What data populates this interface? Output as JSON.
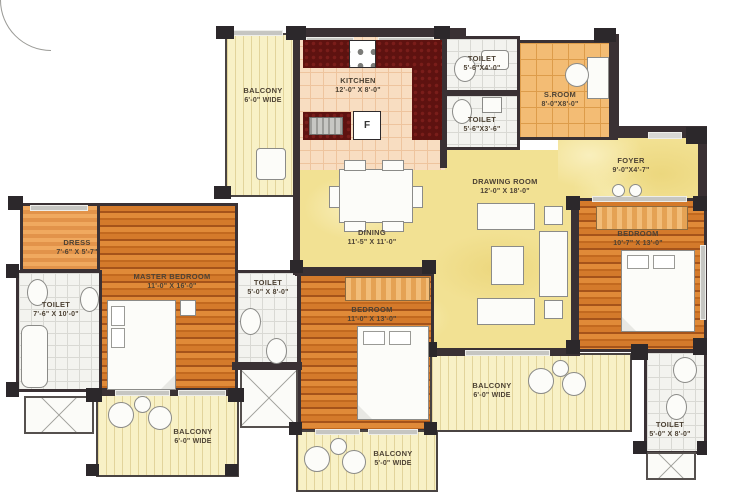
{
  "plan_title": "3 BHK Apartment Floor Plan",
  "colors": {
    "wall": "#3a3134",
    "wood_floor": "#d47a2b",
    "marble_floor": "#f2e193",
    "balcony_floor": "#f8f1c6",
    "kitchen_counter": "#5e1210",
    "tile_orange": "#f3bc74",
    "tile_white": "#f3f3ef",
    "label_text": "#4d4234"
  },
  "rooms": [
    {
      "id": "balcony-top-left",
      "name": "BALCONY",
      "dims": "6'-0\" WIDE"
    },
    {
      "id": "kitchen",
      "name": "KITCHEN",
      "dims": "12'-0\" X 8'-0\""
    },
    {
      "id": "toilet-top",
      "name": "TOILET",
      "dims": "5'-6\"X4'-0\""
    },
    {
      "id": "toilet-upper-mid",
      "name": "TOILET",
      "dims": "5'-6\"X3'-6\""
    },
    {
      "id": "servant-room",
      "name": "S.ROOM",
      "dims": "8'-0\"X8'-0\""
    },
    {
      "id": "foyer",
      "name": "FOYER",
      "dims": "9'-0\"X4'-7\""
    },
    {
      "id": "drawing-room",
      "name": "DRAWING ROOM",
      "dims": "12'-0\" X 18'-0\""
    },
    {
      "id": "dining",
      "name": "DINING",
      "dims": "11'-5\" X 11'-0\""
    },
    {
      "id": "dress",
      "name": "DRESS",
      "dims": "7'-6\" X 5'-7\""
    },
    {
      "id": "master-bedroom",
      "name": "MASTER BEDROOM",
      "dims": "11'-0\" X 16'-0\""
    },
    {
      "id": "toilet-master",
      "name": "TOILET",
      "dims": "7'-6\" X 10'-0\""
    },
    {
      "id": "toilet-middle",
      "name": "TOILET",
      "dims": "5'-0\" X 8'-0\""
    },
    {
      "id": "bedroom-middle",
      "name": "BEDROOM",
      "dims": "11'-0\" X 13'-0\""
    },
    {
      "id": "bedroom-right",
      "name": "BEDROOM",
      "dims": "10'-7\" X 13'-0\""
    },
    {
      "id": "balcony-bottom-right",
      "name": "BALCONY",
      "dims": "6'-0\" WIDE"
    },
    {
      "id": "toilet-bottom-right",
      "name": "TOILET",
      "dims": "5'-0\" X 8'-0\""
    },
    {
      "id": "balcony-bottom-left",
      "name": "BALCONY",
      "dims": "6'-0\" WIDE"
    },
    {
      "id": "balcony-bottom-mid",
      "name": "BALCONY",
      "dims": "5'-0\" WIDE"
    }
  ],
  "fixtures": {
    "fridge_label": "F"
  }
}
